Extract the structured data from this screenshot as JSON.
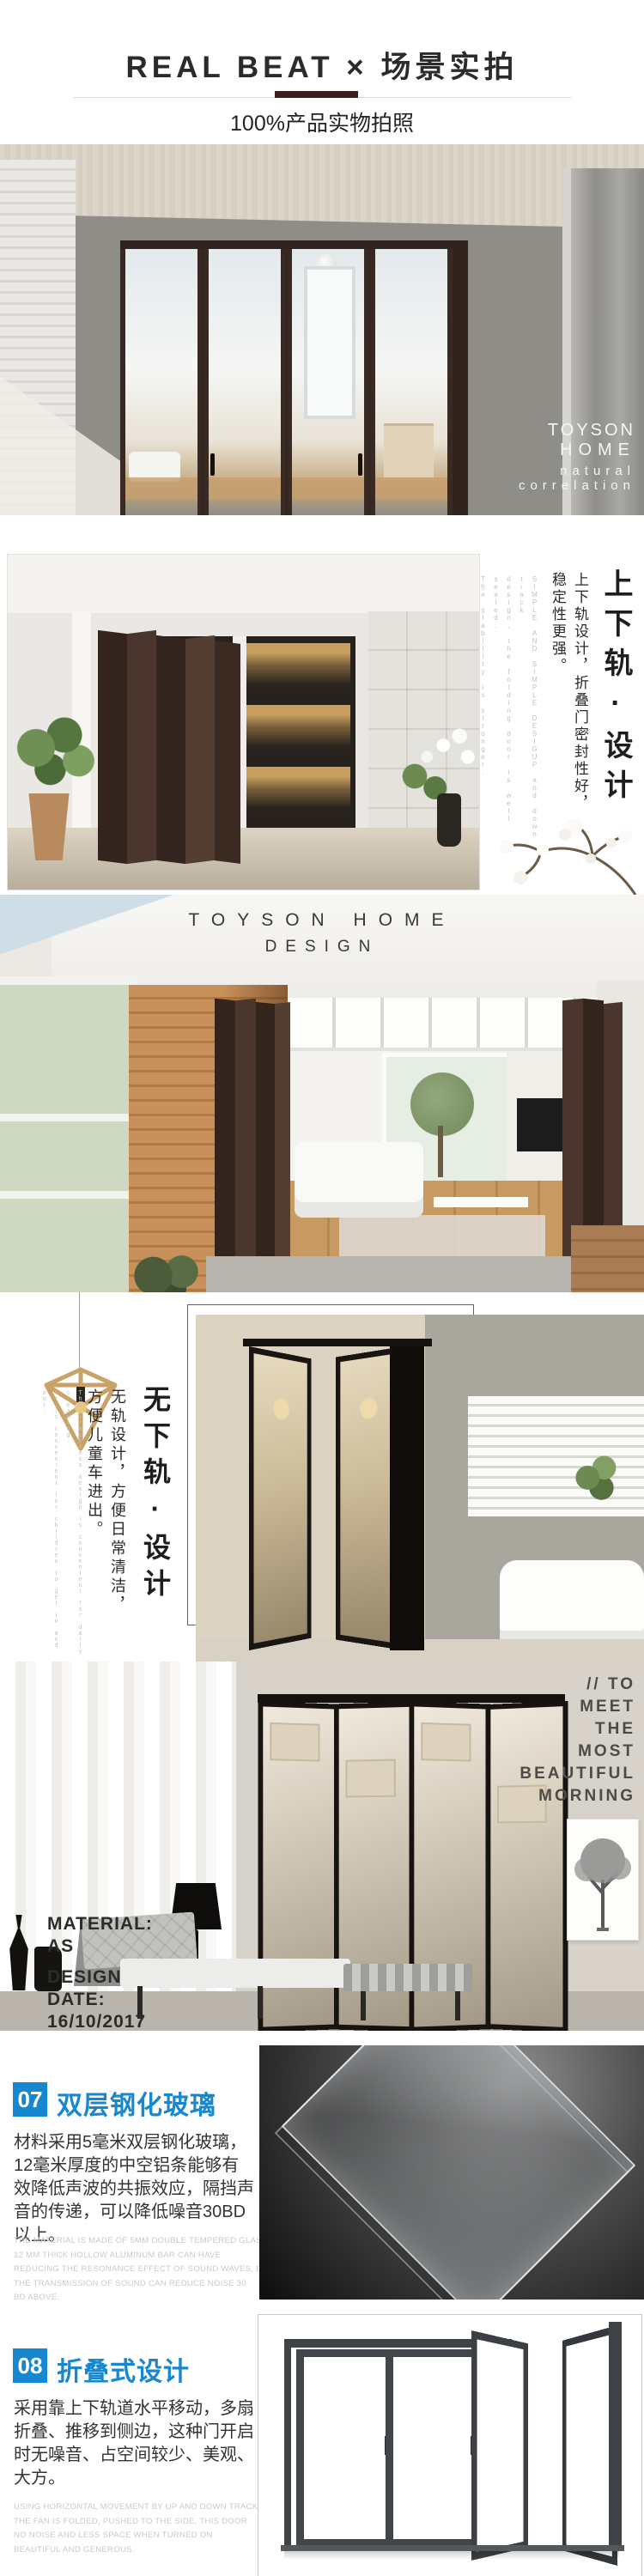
{
  "header": {
    "title": "REAL BEAT × 场景实拍",
    "subtitle": "100%产品实物拍照"
  },
  "photo1": {
    "brand_lines": [
      "TOYSON",
      "HOME"
    ],
    "tagline_lines": [
      "natural",
      "correlation"
    ]
  },
  "section_updown": {
    "heading": "上下轨·设计",
    "body_cols": [
      "上下轨设计，折叠门密封性好，",
      "稳定性更强。"
    ],
    "en_cols": [
      "SIMPLE AND SIMPLE DESIGUP and down track",
      "design, the folding door is well sealed.",
      "The stability is stronger."
    ]
  },
  "photo3": {
    "brand_line1": "TOYSON HOME",
    "brand_line2": "DESIGN"
  },
  "section_trackless": {
    "heading": "无下轨·设计",
    "body_cols": [
      "无轨设计，方便日常清洁，",
      "方便儿童车进出。"
    ],
    "en_cols": [
      "The trackless design is convenient for daily cleaning.",
      "It is convenient for children to get in and out."
    ]
  },
  "section_morning": {
    "slogan_lines": [
      "// TO",
      "MEET",
      "THE",
      "MOST",
      "BEAUTIFUL",
      "MORNING"
    ],
    "material_lines": [
      "MATERIAL:",
      "AS",
      "DESIGN",
      "DATE:",
      "16/10/2017"
    ]
  },
  "feature07": {
    "number": "07",
    "title": "双层钢化玻璃",
    "body": "材料采用5毫米双层钢化玻璃，12毫米厚度的中空铝条能够有效降低声波的共振效应，隔挡声音的传递，可以降低噪音30BD以上。",
    "en_lines": [
      "THE MATERIAL IS MADE OF 5MM DOUBLE TEMPERED GLASS,",
      "12 MM THICK HOLLOW ALUMINUM BAR CAN HAVE",
      "REDUCING THE RESONANCE EFFECT OF SOUND WAVES, BLOCKING",
      "THE TRANSMISSION OF SOUND CAN REDUCE NOISE 30",
      "BD ABOVE."
    ]
  },
  "feature08": {
    "number": "08",
    "title": "折叠式设计",
    "body": "采用靠上下轨道水平移动，多扇折叠、推移到侧边，这种门开启时无噪音、占空间较少、美观、大方。",
    "en_lines": [
      "USING HORIZONTAL MOVEMENT BY UP AND DOWN TRACK, MANY",
      "THE FAN IS FOLDED, PUSHED TO THE SIDE, THIS DOOR",
      "NO NOISE AND LESS SPACE WHEN TURNED ON",
      "BEAUTIFUL AND GENEROUS."
    ]
  },
  "colors": {
    "accent_blue": "#1787d0",
    "divider_brown": "#3f1f1b",
    "door_brown": "#30231d",
    "text_gray": "#ccc9c5"
  }
}
